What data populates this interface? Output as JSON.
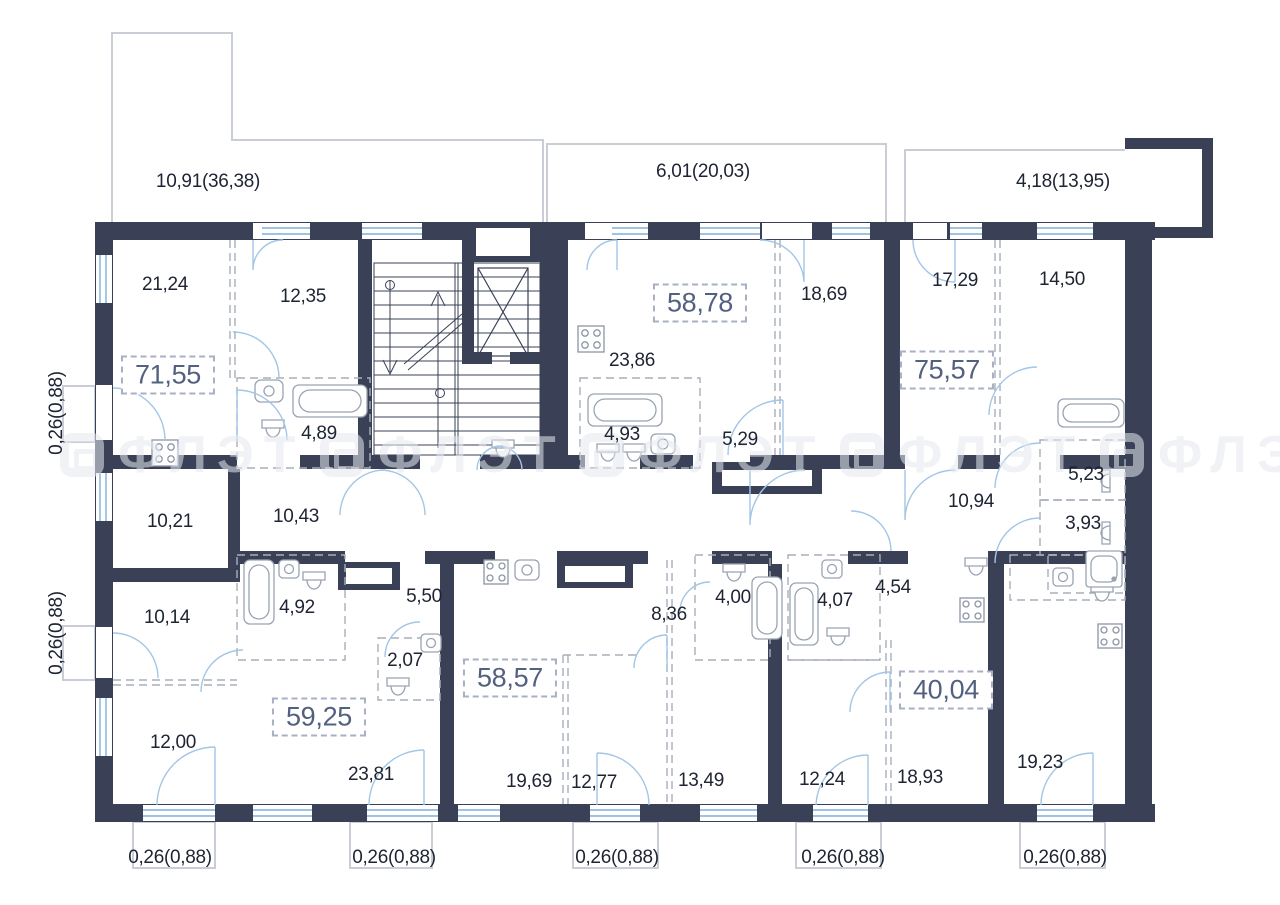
{
  "plan": {
    "title": "apartment-floor-plan",
    "watermark": {
      "text": "ФЛЭТ"
    },
    "colors": {
      "wall": "#3a4157",
      "door_arc": "#a3c6e6",
      "window_line": "#7fb0d8",
      "dashed_partition": "#a8aeba",
      "fixture_outline": "#9aa3b2",
      "balcony_outline": "#c9cdd5",
      "label_text": "#1e2433",
      "boxed_label_text": "#536080"
    }
  },
  "dimensions": {
    "top_left": "10,91(36,38)",
    "top_middle": "6,01(20,03)",
    "top_right": "4,18(13,95)",
    "left_upper": "0,26(0,88)",
    "left_lower": "0,26(0,88)",
    "bottom_1": "0,26(0,88)",
    "bottom_2": "0,26(0,88)",
    "bottom_3": "0,26(0,88)",
    "bottom_4": "0,26(0,88)",
    "bottom_5": "0,26(0,88)"
  },
  "apartment_totals": {
    "apt_1": "71,55",
    "apt_2": "58,78",
    "apt_3": "75,57",
    "apt_4": "59,25",
    "apt_5": "58,57",
    "apt_6": "40,04"
  },
  "room_areas": {
    "r21_24": "21,24",
    "r12_35": "12,35",
    "r23_86": "23,86",
    "r18_69": "18,69",
    "r17_29": "17,29",
    "r14_50": "14,50",
    "r4_89": "4,89",
    "r4_93": "4,93",
    "r5_29": "5,29",
    "r5_23": "5,23",
    "r3_93": "3,93",
    "r10_94": "10,94",
    "r10_21": "10,21",
    "r10_43": "10,43",
    "r10_14": "10,14",
    "r4_92": "4,92",
    "r5_50": "5,50",
    "r2_07": "2,07",
    "r12_00": "12,00",
    "r23_81": "23,81",
    "r19_69": "19,69",
    "r12_77": "12,77",
    "r13_49": "13,49",
    "r8_36": "8,36",
    "r4_00": "4,00",
    "r4_07": "4,07",
    "r4_54": "4,54",
    "r12_24": "12,24",
    "r18_93": "18,93",
    "r19_23": "19,23"
  }
}
